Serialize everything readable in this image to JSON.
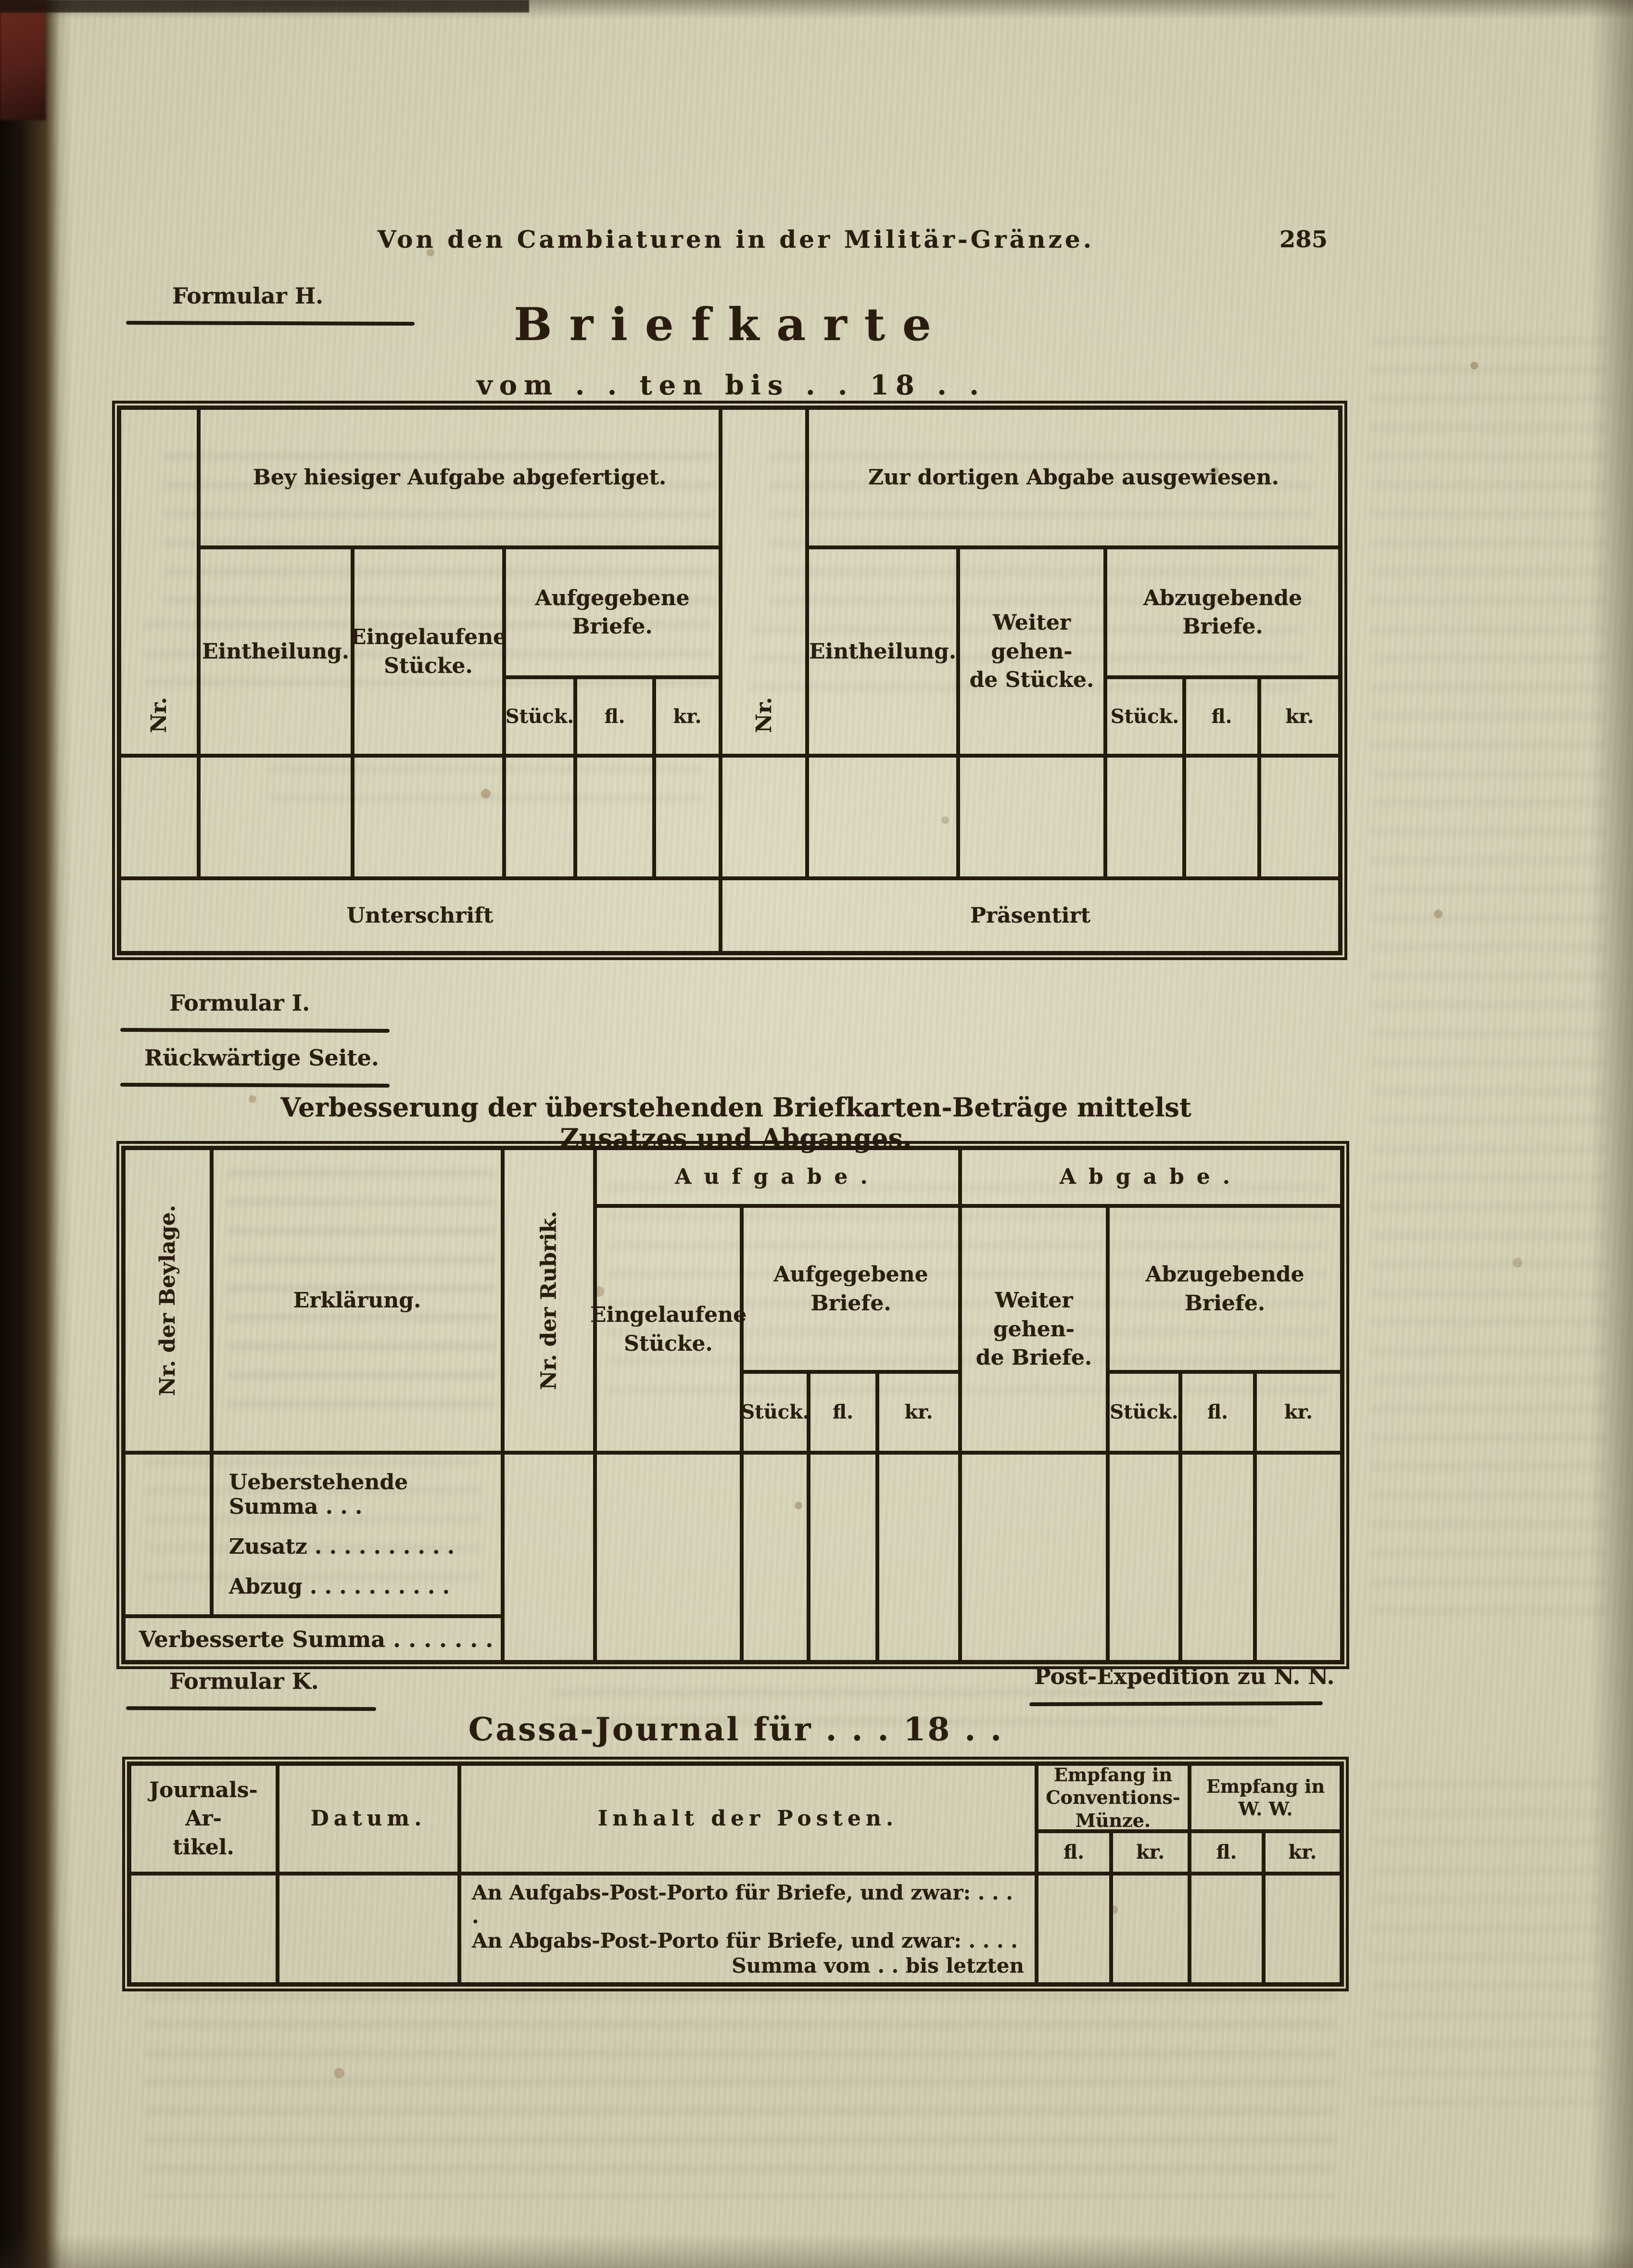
{
  "colors": {
    "paper": "#cdc9ad",
    "ink": "#2a1d10",
    "table_line": "#241a0e",
    "binding": "#16100a",
    "leather_corner": "#5e2219"
  },
  "page": {
    "running_header": "Von den Cambiaturen in der Militär-Gränze.",
    "page_number": "285"
  },
  "formular_h": {
    "label": "Formular H.",
    "title": "Briefkarte",
    "subtitle": "vom . . ten bis . . 18 . .",
    "table": {
      "left_group": "Bey hiesiger Aufgabe abgefertiget.",
      "right_group": "Zur dortigen Abgabe ausgewiesen.",
      "left": {
        "nr": "Nr.",
        "eintheilung": "Eintheilung.",
        "eingelaufene": "Eingelaufene Stücke.",
        "aufgegebene": "Aufgegebene Briefe."
      },
      "right": {
        "nr": "Nr.",
        "eintheilung": "Eintheilung.",
        "weitergehende_1": "Weiter gehen-",
        "weitergehende_2": "de Stücke.",
        "abzugebende": "Abzugebende Briefe."
      },
      "money": [
        "Stück.",
        "fl.",
        "kr."
      ],
      "footer_left": "Unterschrift",
      "footer_right": "Präsentirt"
    }
  },
  "formular_i": {
    "label": "Formular I.",
    "sublabel": "Rückwärtige Seite.",
    "title": "Verbesserung der überstehenden Briefkarten-Beträge mittelst Zusatzes und Abganges.",
    "table": {
      "beylage": "Nr. der Beylage.",
      "erklaerung": "Erklärung.",
      "rubrik": "Nr. der Rubrik.",
      "aufgabe": "Aufgabe.",
      "abgabe": "Abgabe.",
      "eingelaufene": "Eingelaufene Stücke.",
      "aufgegebene": "Aufgegebene Briefe.",
      "weitergehende_1": "Weiter gehen-",
      "weitergehende_2": "de Briefe.",
      "abzugebende": "Abzugebende Briefe.",
      "money": [
        "Stück.",
        "fl.",
        "kr."
      ],
      "rows": [
        "Ueberstehende Summa . . .",
        "Zusatz . . . . . . . . . .",
        "Abzug . . . . . . . . . ."
      ],
      "footer": "Verbesserte Summa . . . . . . ."
    }
  },
  "formular_k": {
    "label": "Formular K.",
    "expedition": "Post-Expedition zu N. N.",
    "title": "Cassa-Journal für . . . 18 . .",
    "table": {
      "journal_1": "Journals-Ar-",
      "journal_2": "tikel.",
      "datum": "Datum.",
      "inhalt": "Inhalt der Posten.",
      "empfang_cm_1": "Empfang in",
      "empfang_cm_2": "Conventions-",
      "empfang_cm_3": "Münze.",
      "empfang_ww_1": "Empfang in",
      "empfang_ww_2": "W. W.",
      "money": [
        "fl.",
        "kr."
      ],
      "rows": [
        "An Aufgabs-Post-Porto für Briefe, und zwar: . . . .",
        "An Abgabs-Post-Porto für Briefe, und zwar: . . . .",
        "Summa vom . . bis letzten"
      ]
    }
  }
}
